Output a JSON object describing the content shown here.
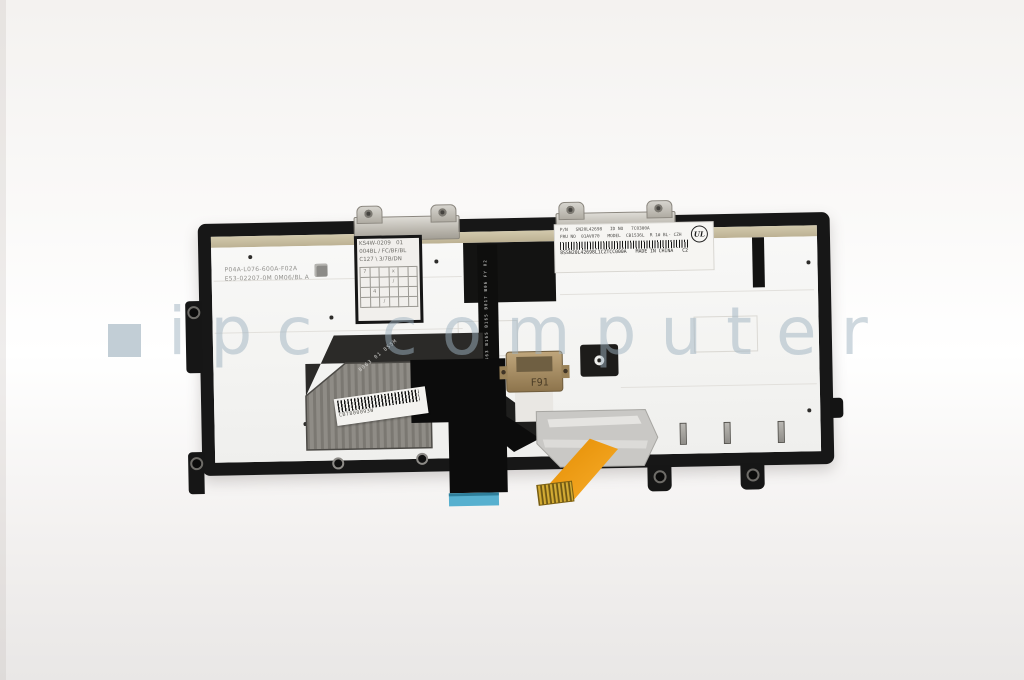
{
  "watermark": {
    "text": "ipc computer",
    "square_icon": "wm-square-icon",
    "color": "#9eb2bf"
  },
  "keyboard": {
    "left_label": {
      "line1": "P04A-L076-600A-F02A",
      "line2": "E53-02207-0M 0M06/BL A"
    },
    "grid_label": {
      "line1": "KS4W-0209   01",
      "line2": "004BL / FC/BF/BL",
      "line3": "C127 \\ 3/7B/DN",
      "marks": {
        "m0": "7",
        "m3": "x",
        "m9": "/",
        "m13": "4",
        "m20": "/"
      }
    },
    "main_label": {
      "row1": "P/N   SN20L42698   ID NO   7C0300A",
      "row2": "FRU NO  01AV070   MODEL  CB1536L  R 1# BL- CZH",
      "barcode_text": "8SSN20L42698L1CZTCC000A",
      "made_in": "MADE IN CHINA",
      "rev": "C2",
      "cert_mark": "UL"
    },
    "module_label": {
      "barcode_text": "CB7800093W"
    },
    "bracket_marks": "B063 01 8S5M",
    "flex_vertical_text": "8S5M20 B0463 B165 B165 B017 B06 FY 02 C1 CN",
    "connector_text": "F91",
    "colors": {
      "frame": "#171717",
      "top_strip": "#c8bda0",
      "orange_cable": "#f09a10",
      "blue_connector": "#57b0cf",
      "gold_connector": "#b0946a",
      "foil": "#c9c8c5"
    }
  }
}
